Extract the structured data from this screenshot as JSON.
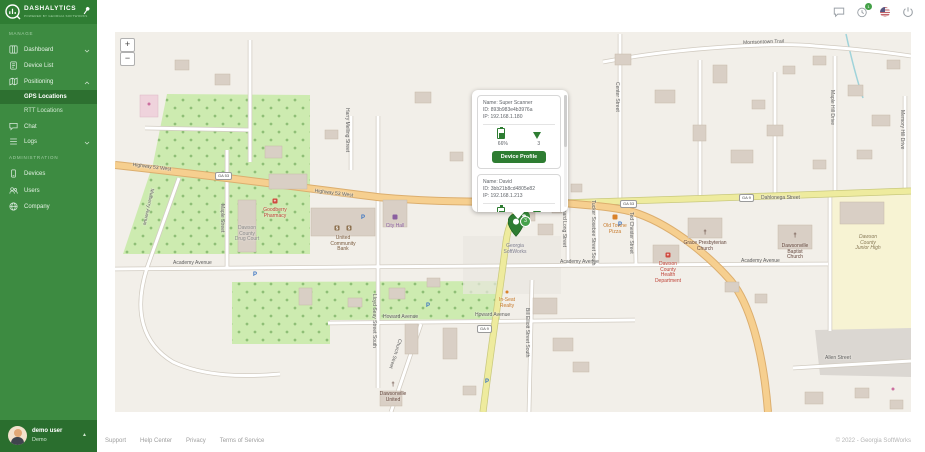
{
  "brand": {
    "name": "DASHALYTICS",
    "tagline": "POWERED BY GEORGIA SOFTWORKS"
  },
  "topbar": {
    "notification_count": "1"
  },
  "sidebar": {
    "sections": [
      {
        "label": "MANAGE"
      },
      {
        "label": "ADMINISTRATION"
      }
    ],
    "items": {
      "dashboard": "Dashboard",
      "device_list": "Device List",
      "positioning": "Positioning",
      "gps": "GPS Locations",
      "rtt": "RTT Locations",
      "chat": "Chat",
      "logs": "Logs",
      "devices": "Devices",
      "users": "Users",
      "company": "Company"
    },
    "user": {
      "name": "demo user",
      "role": "Demo"
    }
  },
  "map": {
    "zoom_in": "+",
    "zoom_out": "−",
    "cluster_count": "3",
    "popup": {
      "devices": [
        {
          "name_label": "Name: Super Scanner",
          "id_label": "ID: 893b983e4b3976a",
          "ip_label": "IP: 192.168.1.180",
          "battery": "66%",
          "signal": "3",
          "button": "Device Profile"
        },
        {
          "name_label": "Name: David",
          "id_label": "ID: 3bb21b8cd4805e82",
          "ip_label": "IP: 192.168.1.213",
          "battery": "67%",
          "signal": "4"
        }
      ]
    },
    "road_badges": [
      {
        "t": "GA 53",
        "x": 100,
        "y": 140
      },
      {
        "t": "GA 53",
        "x": 505,
        "y": 168
      },
      {
        "t": "GA 9",
        "x": 362,
        "y": 293
      },
      {
        "t": "GA 9",
        "x": 624,
        "y": 162
      }
    ],
    "street_labels": [
      {
        "t": "Highway 53 West",
        "x": 18,
        "y": 130,
        "r": 7
      },
      {
        "t": "Highway 53 West",
        "x": 200,
        "y": 156,
        "r": 7
      },
      {
        "t": "Morrisontown Trail",
        "x": 628,
        "y": 8,
        "r": -2
      },
      {
        "t": "Dahlonega Street",
        "x": 646,
        "y": 163
      },
      {
        "t": "Academy Avenue",
        "x": 58,
        "y": 228
      },
      {
        "t": "Academy Avenue",
        "x": 445,
        "y": 227
      },
      {
        "t": "Academy Avenue",
        "x": 626,
        "y": 226
      },
      {
        "t": "Howard Avenue",
        "x": 268,
        "y": 282
      },
      {
        "t": "Howard Avenue",
        "x": 360,
        "y": 280
      },
      {
        "t": "Allen Street",
        "x": 710,
        "y": 323
      },
      {
        "t": "Mulberry Avenue",
        "x": 34,
        "y": 156,
        "v": 1,
        "r": 12
      },
      {
        "t": "Maple Street",
        "x": 104,
        "y": 172,
        "v": 1
      },
      {
        "t": "Harry Melling Street",
        "x": 229,
        "y": 76,
        "v": 1
      },
      {
        "t": "Lloyd Seay Street South",
        "x": 256,
        "y": 262,
        "v": 1
      },
      {
        "t": "Church Street",
        "x": 282,
        "y": 306,
        "v": 1,
        "r": 18
      },
      {
        "t": "Bernard Long Street",
        "x": 446,
        "y": 170,
        "v": 1
      },
      {
        "t": "Tucker Sosebee Street South",
        "x": 475,
        "y": 168,
        "v": 1
      },
      {
        "t": "Ted Chester Street",
        "x": 513,
        "y": 180,
        "v": 1
      },
      {
        "t": "Bill Elliott Street South",
        "x": 409,
        "y": 276,
        "v": 1
      },
      {
        "t": "Maple Hill Drive",
        "x": 714,
        "y": 58,
        "v": 1
      },
      {
        "t": "Memory Hill Drive",
        "x": 784,
        "y": 78,
        "v": 1
      },
      {
        "t": "Center Street",
        "x": 499,
        "y": 50,
        "v": 1
      }
    ],
    "poi_labels": [
      {
        "lines": [
          "Goodberry",
          "Pharmacy"
        ],
        "x": 160,
        "y": 176,
        "cls": "c-red"
      },
      {
        "lines": [
          "Dawson",
          "County",
          "Drug Court"
        ],
        "x": 132,
        "y": 194,
        "cls": "c-gray"
      },
      {
        "lines": [
          "United",
          "Community",
          "Bank"
        ],
        "x": 228,
        "y": 204,
        "cls": "c-brown"
      },
      {
        "lines": [
          "City Hall"
        ],
        "x": 280,
        "y": 192,
        "cls": "c-purple"
      },
      {
        "lines": [
          "Old Towne",
          "Pizza"
        ],
        "x": 500,
        "y": 192,
        "cls": "c-orange"
      },
      {
        "lines": [
          "Grace Presbyterian",
          "Church"
        ],
        "x": 590,
        "y": 209,
        "cls": "c-church"
      },
      {
        "lines": [
          "Dawsonville",
          "Baptist",
          "Church"
        ],
        "x": 680,
        "y": 212,
        "cls": "c-church"
      },
      {
        "lines": [
          "Dawson",
          "County",
          "Health",
          "Department"
        ],
        "x": 553,
        "y": 230,
        "cls": "c-red"
      },
      {
        "lines": [
          "Dawson",
          "County",
          "Junior High"
        ],
        "x": 753,
        "y": 203,
        "cls": "c-school"
      },
      {
        "lines": [
          "Georgia",
          "SoftWorks"
        ],
        "x": 400,
        "y": 212,
        "cls": "c-office"
      },
      {
        "lines": [
          "In-Seat",
          "Realty"
        ],
        "x": 392,
        "y": 266,
        "cls": "c-orange"
      },
      {
        "lines": [
          "Dawsonville",
          "United"
        ],
        "x": 278,
        "y": 360,
        "cls": "c-church"
      }
    ],
    "poi_icons": [
      {
        "name": "pharmacy",
        "kind": "sq",
        "glyph": "+",
        "color": "#cf4a3f",
        "x": 160,
        "y": 169
      },
      {
        "name": "bank",
        "kind": "sq",
        "glyph": "$",
        "color": "#8a6d4b",
        "x": 222,
        "y": 196
      },
      {
        "name": "bank",
        "kind": "sq",
        "glyph": "$",
        "color": "#8a6d4b",
        "x": 234,
        "y": 196
      },
      {
        "name": "city-hall",
        "kind": "sq",
        "glyph": "",
        "color": "#8b5fa0",
        "x": 280,
        "y": 185
      },
      {
        "name": "restaurant",
        "kind": "sq",
        "glyph": "",
        "color": "#d9822b",
        "x": 500,
        "y": 185
      },
      {
        "name": "church-cross",
        "kind": "glyph",
        "glyph": "†",
        "color": "#5d4037",
        "x": 590,
        "y": 201
      },
      {
        "name": "church-cross",
        "kind": "glyph",
        "glyph": "†",
        "color": "#5d4037",
        "x": 680,
        "y": 204
      },
      {
        "name": "church-cross",
        "kind": "glyph",
        "glyph": "†",
        "color": "#5d4037",
        "x": 278,
        "y": 353
      },
      {
        "name": "hospital",
        "kind": "sq",
        "glyph": "+",
        "color": "#cf4a3f",
        "x": 553,
        "y": 223
      },
      {
        "name": "realty",
        "kind": "dot",
        "glyph": "",
        "color": "#d9822b",
        "x": 392,
        "y": 260
      },
      {
        "name": "shop",
        "kind": "dot",
        "glyph": "",
        "color": "#cc6fa0",
        "x": 34,
        "y": 72
      },
      {
        "name": "shop",
        "kind": "dot",
        "glyph": "",
        "color": "#cc6fa0",
        "x": 778,
        "y": 357
      },
      {
        "name": "parking",
        "kind": "glyph",
        "glyph": "P",
        "color": "#3b74c2",
        "x": 313,
        "y": 274
      },
      {
        "name": "parking",
        "kind": "glyph",
        "glyph": "P",
        "color": "#3b74c2",
        "x": 505,
        "y": 193
      },
      {
        "name": "parking",
        "kind": "glyph",
        "glyph": "P",
        "color": "#3b74c2",
        "x": 372,
        "y": 350
      },
      {
        "name": "parking",
        "kind": "glyph",
        "glyph": "P",
        "color": "#3b74c2",
        "x": 140,
        "y": 243
      },
      {
        "name": "parking",
        "kind": "glyph",
        "glyph": "P",
        "color": "#3b74c2",
        "x": 248,
        "y": 186
      }
    ]
  },
  "footer": {
    "links": [
      "Support",
      "Help Center",
      "Privacy",
      "Terms of Service"
    ],
    "copyright": "© 2022 - Georgia SoftWorks"
  },
  "colors": {
    "sidebar": "#3d8b41",
    "sidebar_dark": "#2f7d33",
    "accent": "#2e7d32",
    "badge": "#43a047"
  }
}
